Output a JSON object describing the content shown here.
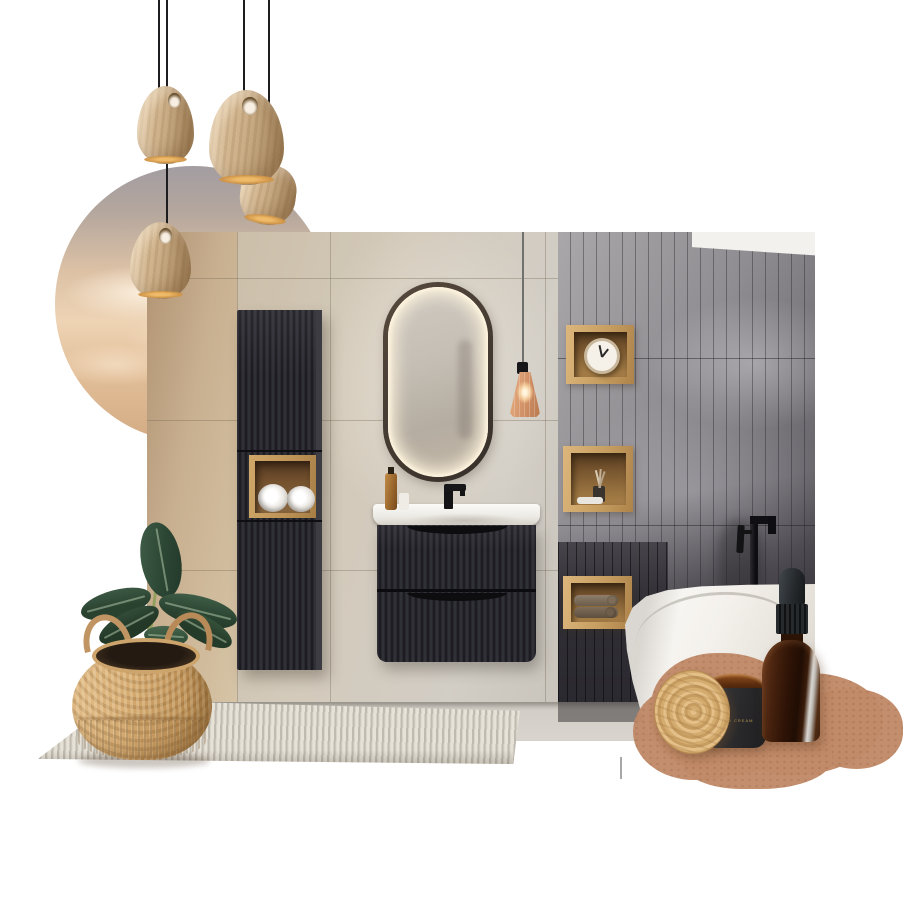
{
  "title": "bathroom interior moodboard collage",
  "background": "#ffffff",
  "palette": {
    "wood": "#c9a26a",
    "black_furniture": "#232228",
    "beige_wall": "#d0c4ab",
    "gray_tile": "#86838a",
    "terracotta_swatch": "#c18a68",
    "amber_glass": "#6b3a1e",
    "leaf_green": "#35523d",
    "led_glow": "#f5e9d2"
  },
  "objects": {
    "pendant_lamps": {
      "label": "wooden pendant lamps",
      "count": 4
    },
    "sky_circle": {
      "label": "sunset sky circle photo"
    },
    "bathroom": {
      "label": "bathroom interior photo",
      "items": [
        "beige tile wall",
        "fluted tall cabinet with towel niche",
        "oval LED mirror",
        "amber glass pendant",
        "fluted vanity with white basin",
        "black basin faucet",
        "soap bottles",
        "gray glossy tile wall",
        "three oak wall cubes",
        "alarm clock",
        "reed diffuser",
        "rolled towels",
        "dark panelled wall",
        "freestanding white bathtub",
        "black tub faucet"
      ]
    },
    "plant": {
      "label": "rubber plant in seagrass belly basket"
    },
    "rug": {
      "label": "striped beige rug"
    },
    "paint_swatch": {
      "label": "terracotta paint swatch"
    },
    "candle_jar": {
      "label_text": "HAND CREAM",
      "description": "amber glass jar with black label"
    },
    "wooden_lid": {
      "label": "bamboo jar lid"
    },
    "dropper_bottle": {
      "label": "amber glass dropper bottle"
    },
    "drip_mark": {
      "label": "paint drip mark"
    }
  }
}
